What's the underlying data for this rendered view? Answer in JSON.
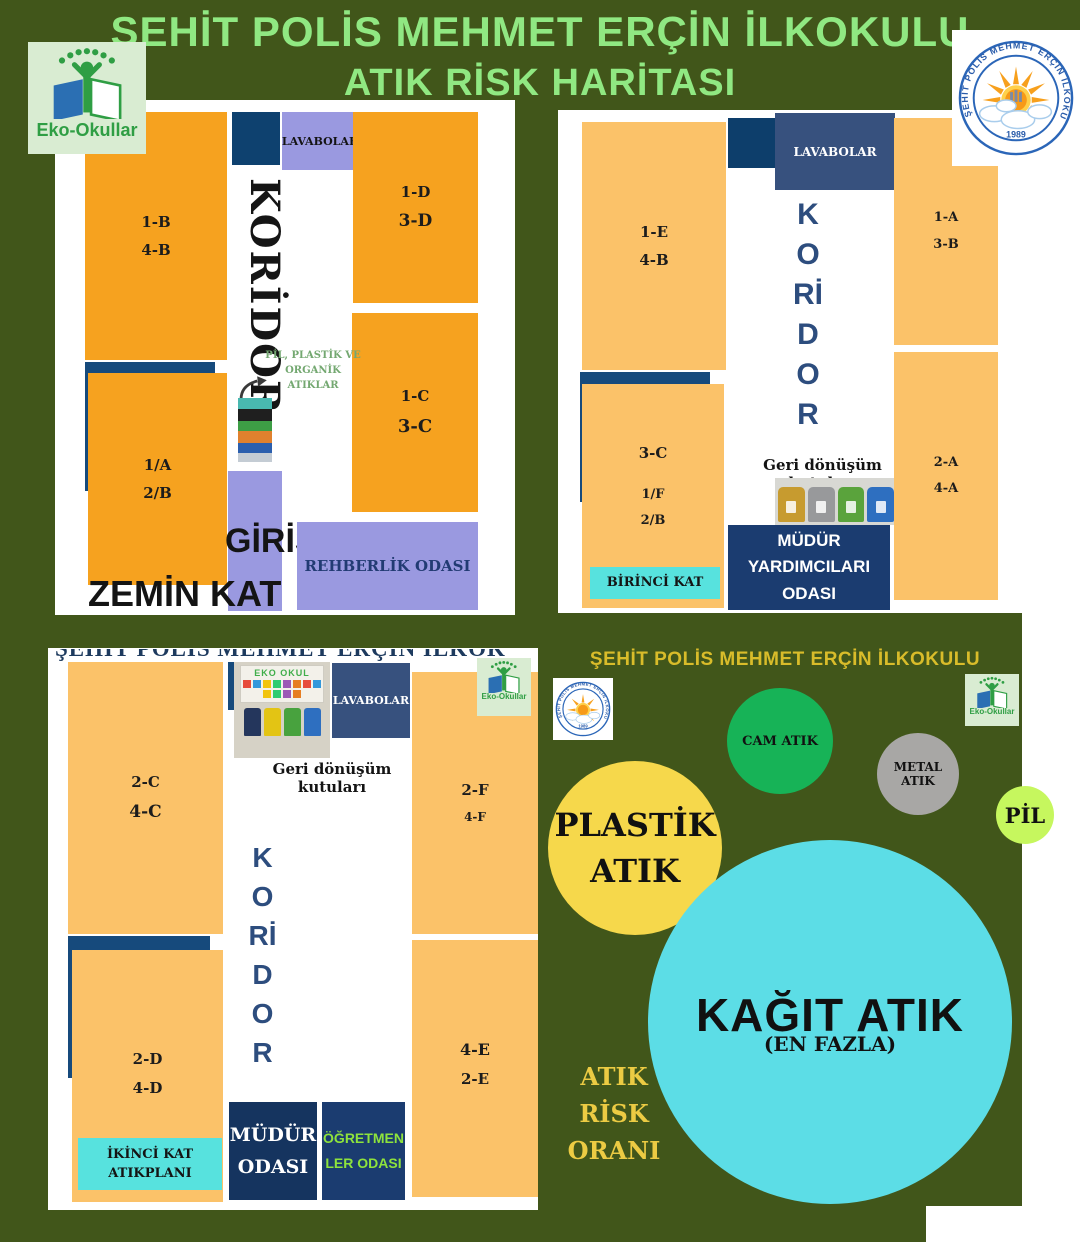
{
  "header": {
    "title_line1": "ŞEHİT POLİS MEHMET ERÇİN İLKOKULU",
    "title_line2": "ATIK RİSK HARİTASI"
  },
  "logos": {
    "eko_label": "Eko-Okullar",
    "school_name": "ŞEHİT POLİS MEHMET ERÇİN İLKOKULU",
    "school_year": "1989"
  },
  "zemin_kat": {
    "floor_label": "ZEMİN KAT",
    "lavabolar": "LAVABOLAR",
    "koridor": "KORİDOR",
    "giris": "GİRİŞ",
    "rehberlik": "REHBERLİK ODASI",
    "note": [
      "PİL, PLASTİK VE",
      "ORGANİK",
      "ATIKLAR"
    ],
    "rooms": [
      {
        "lines": [
          "1-B",
          "4-B"
        ]
      },
      {
        "lines": [
          "1-D",
          "3-D"
        ]
      },
      {
        "lines": [
          "1-C",
          "3-C"
        ]
      },
      {
        "lines": [
          "1/A",
          "2/B"
        ]
      }
    ]
  },
  "birinci_kat": {
    "floor_label": "BİRİNCİ KAT",
    "lavabolar": "LAVABOLAR",
    "koridor_letters": [
      "K",
      "O",
      "Rİ",
      "D",
      "O",
      "R"
    ],
    "geri_donusum": "Geri dönüşüm kutuları",
    "mudur_yardimcilari": [
      "MÜDÜR",
      "YARDIMCILARI",
      "ODASI"
    ],
    "rooms": [
      {
        "lines": [
          "1-E",
          "4-B"
        ]
      },
      {
        "lines": [
          "3-C",
          "1/F",
          "2/B"
        ]
      },
      {
        "lines": [
          "1-A",
          "3-B"
        ]
      },
      {
        "lines": [
          "2-A",
          "4-A"
        ]
      }
    ]
  },
  "ikinci_kat": {
    "clipped_title": "ŞEHİT POLİS MEHMET ERÇİN İLKOKULU",
    "floor_label": [
      "İKİNCİ KAT",
      "ATIKPLANI"
    ],
    "lavabolar": "LAVABOLAR",
    "koridor_letters": [
      "K",
      "O",
      "Rİ",
      "D",
      "O",
      "R"
    ],
    "geri_donusum": "Geri dönüşüm kutuları",
    "photo_title": "EKO OKUL",
    "mudur": [
      "MÜDÜR",
      "ODASI"
    ],
    "ogretmenler": [
      "ÖĞRETMEN",
      "LER ODASI"
    ],
    "rooms": [
      {
        "lines": [
          "2-C",
          "4-C"
        ]
      },
      {
        "lines": [
          "2-F",
          "4-F"
        ]
      },
      {
        "lines": [
          "2-D",
          "4-D"
        ]
      },
      {
        "lines": [
          "4-E",
          "2-E"
        ]
      }
    ]
  },
  "risk_panel": {
    "title": "ŞEHİT POLİS MEHMET ERÇİN İLKOKULU",
    "axis_label": [
      "ATIK",
      "RİSK",
      "ORANI"
    ],
    "bubbles": {
      "cam": "CAM ATIK",
      "metal": [
        "METAL",
        "ATIK"
      ],
      "pil": "PİL",
      "plastik": [
        "PLASTİK",
        "ATIK"
      ],
      "kagit": "KAĞIT ATIK",
      "kagit_note": "(EN FAZLA)"
    }
  },
  "chart_data": {
    "type": "bubble",
    "title": "ATIK RİSK ORANI",
    "items": [
      {
        "label": "KAĞIT ATIK",
        "note": "(EN FAZLA)",
        "radius_px": 182,
        "color": "#5cdde6"
      },
      {
        "label": "PLASTİK ATIK",
        "radius_px": 87,
        "color": "#f6d84b"
      },
      {
        "label": "CAM ATIK",
        "radius_px": 53,
        "color": "#17b357"
      },
      {
        "label": "METAL ATIK",
        "radius_px": 41,
        "color": "#a8a7a5"
      },
      {
        "label": "PİL",
        "radius_px": 29,
        "color": "#c6f75e"
      }
    ]
  },
  "colors": {
    "background_green": "#41561a",
    "title_green": "#90e882",
    "room_orange_bright": "#f6a21f",
    "room_orange_light": "#fbc269",
    "purple": "#9a99e0",
    "navy": "#1b3c70",
    "cyan_label": "#57e2de",
    "risk_title_yellow": "#d9bc2a"
  }
}
